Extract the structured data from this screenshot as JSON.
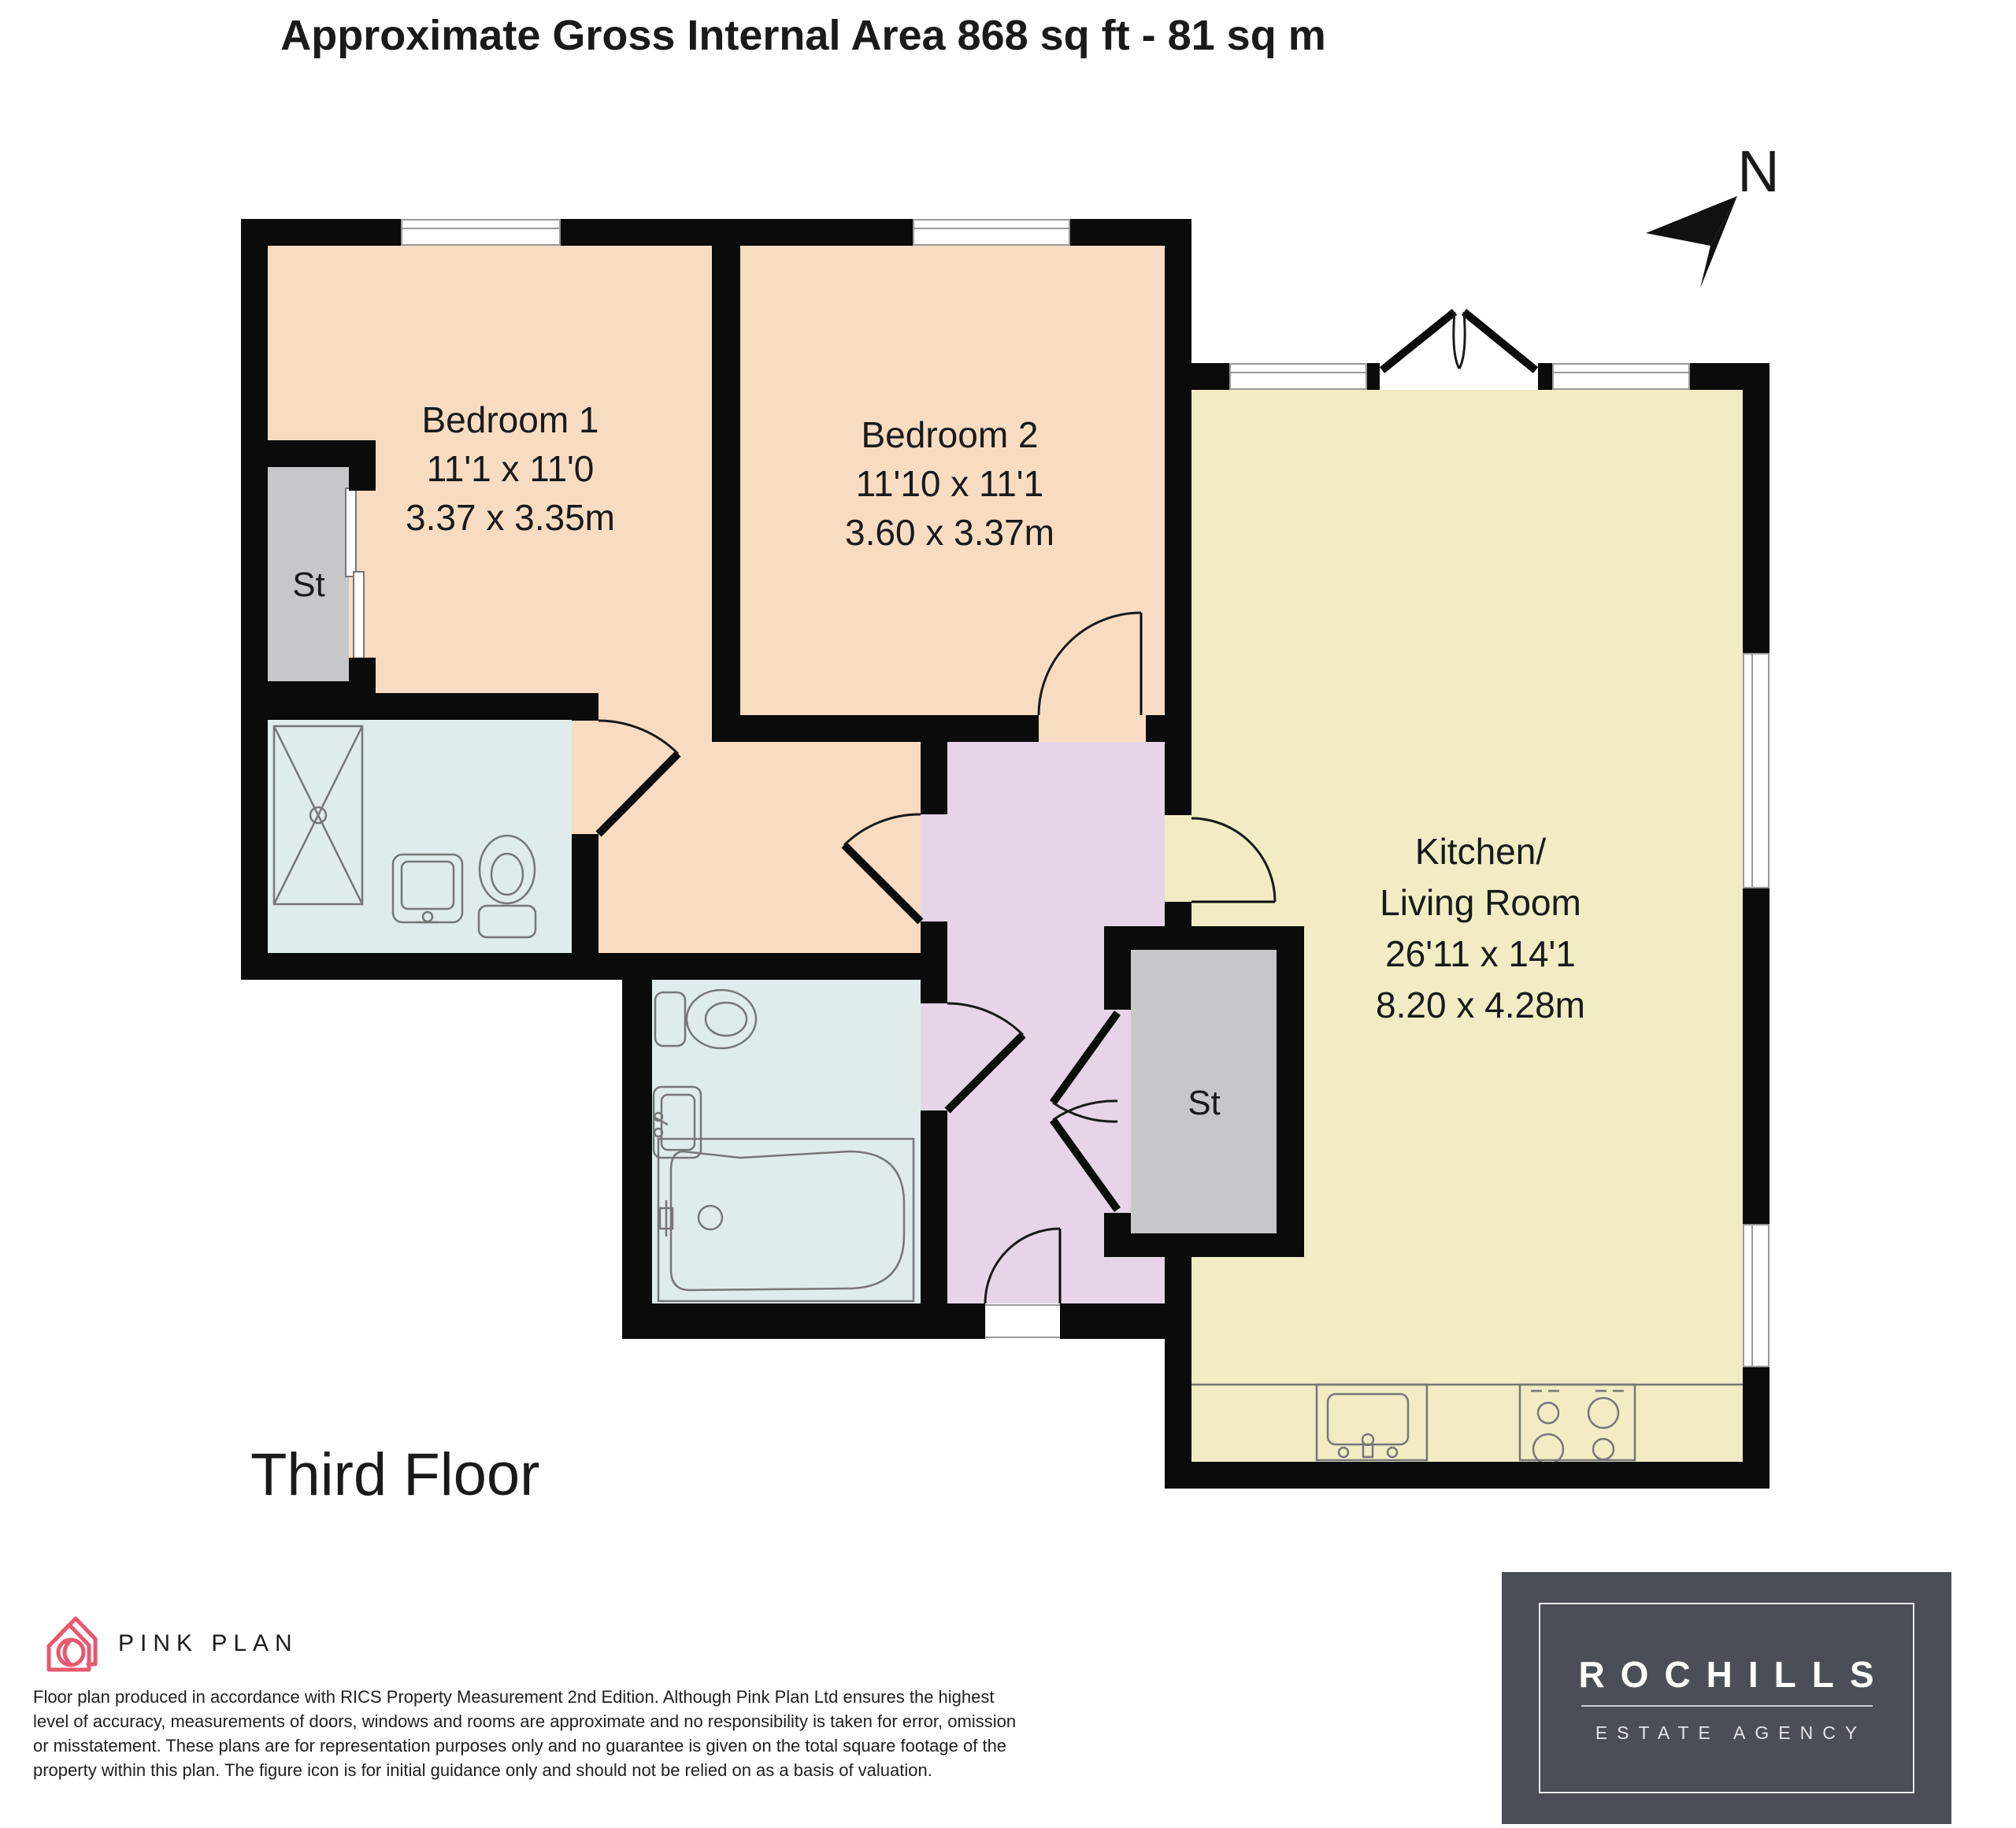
{
  "title": "Approximate Gross Internal Area 868 sq ft - 81 sq m",
  "floor_label": "Third Floor",
  "compass_label": "N",
  "rooms": {
    "bedroom1": {
      "name": "Bedroom 1",
      "imperial": "11'1 x 11'0",
      "metric": "3.37 x 3.35m"
    },
    "bedroom2": {
      "name": "Bedroom 2",
      "imperial": "11'10 x 11'1",
      "metric": "3.60 x 3.37m"
    },
    "kitchen": {
      "name_line1": "Kitchen/",
      "name_line2": "Living Room",
      "imperial": "26'11 x 14'1",
      "metric": "8.20 x 4.28m"
    },
    "storage1": {
      "label": "St"
    },
    "storage2": {
      "label": "St"
    }
  },
  "footer": {
    "pink_plan_brand": "PINK PLAN",
    "disclaimer_lines": [
      "Floor plan produced in accordance with RICS Property Measurement 2nd Edition. Although Pink Plan Ltd ensures the highest",
      "level of accuracy, measurements of doors, windows and rooms are approximate and no responsibility is taken for error, omission",
      "or misstatement. These plans are for representation purposes only and no guarantee is given on the total square footage of the",
      "property within this plan. The figure icon is for initial guidance only and should not be relied on as a basis of valuation."
    ],
    "agency_name": "ROCHILLS",
    "agency_tagline": "ESTATE AGENCY"
  },
  "colors": {
    "room_bedroom": "#F8DCC2",
    "room_kitchen": "#F1ECC4",
    "room_bath": "#DFECEB",
    "room_hall": "#E5D5E7",
    "room_storage": "#C7C6C9",
    "wall": "#0B0B0B",
    "brand_pink": "#E8586F",
    "agency_bg": "#4A4F57"
  }
}
